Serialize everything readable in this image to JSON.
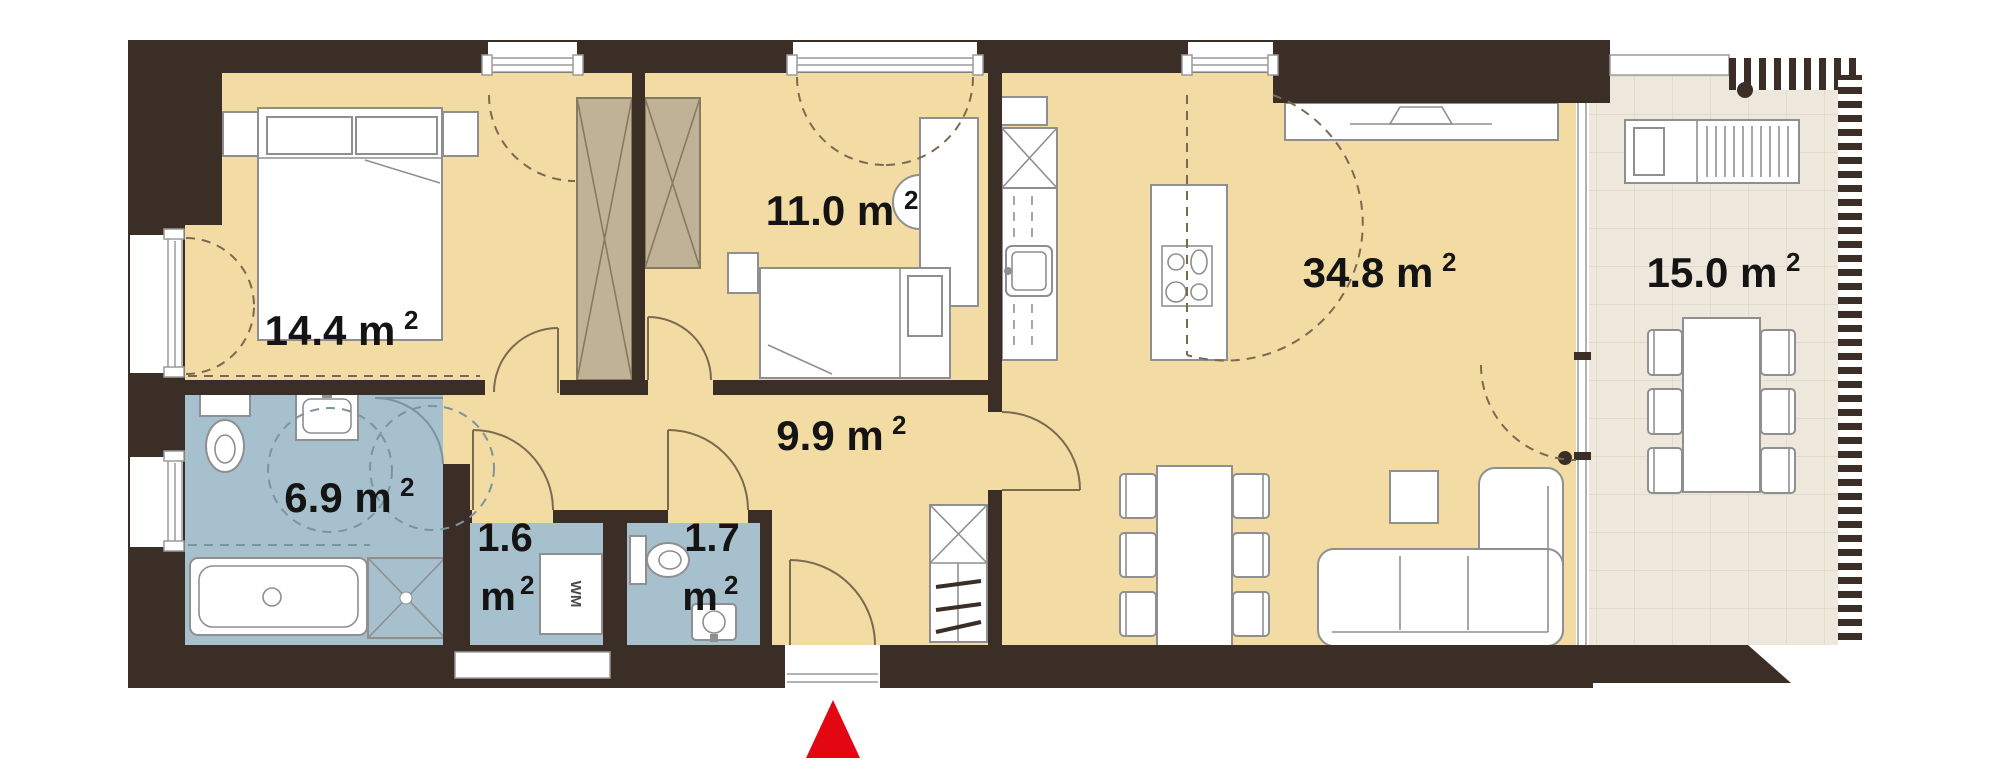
{
  "plan": {
    "unit_superscript": "2",
    "rooms": [
      {
        "id": "bedroom",
        "area_label": "14.4 m"
      },
      {
        "id": "child-room",
        "area_label": "11.0 m"
      },
      {
        "id": "living-kitchen",
        "area_label": "34.8 m"
      },
      {
        "id": "terrace",
        "area_label": "15.0 m"
      },
      {
        "id": "hallway",
        "area_label": "9.9 m"
      },
      {
        "id": "bathroom",
        "area_label": "6.9 m"
      },
      {
        "id": "utility",
        "value": "1.6",
        "unit": "m"
      },
      {
        "id": "wc",
        "value": "1.7",
        "unit": "m"
      }
    ],
    "appliances": {
      "washing_machine": "WM"
    },
    "colors": {
      "wall": "#3B2E27",
      "floor": "#F3DCA4",
      "wet_room": "#A7C0CE",
      "wardrobe": "#C0B297",
      "terrace": "#EDE8DB",
      "entrance_marker": "#E30613"
    }
  }
}
